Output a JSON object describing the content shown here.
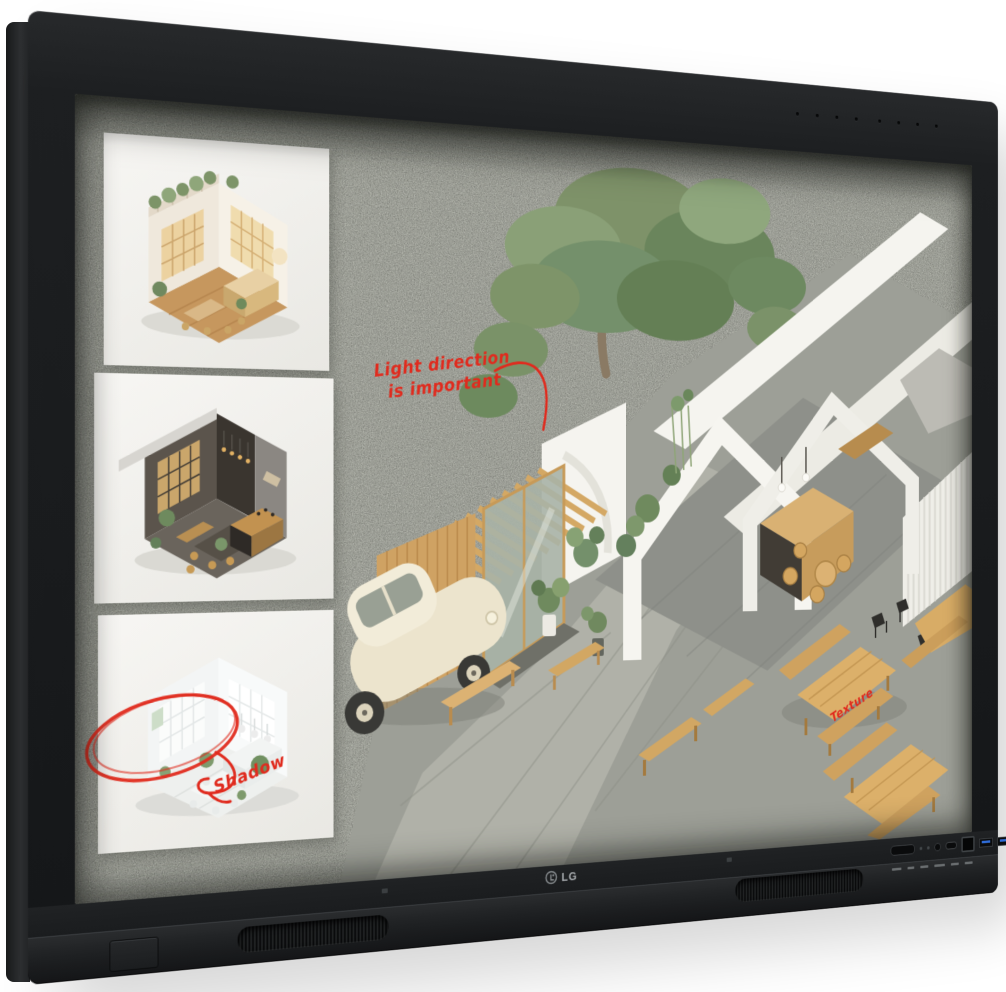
{
  "monitor": {
    "brand_logo": "LG",
    "bezel_color": "#1d1f21",
    "usb_accent_color": "#2f6cd8",
    "mic_hole_count": 8
  },
  "board": {
    "felt_color": "#b0b3a8",
    "ink_color": "#e02b1e",
    "annotations": {
      "light_direction_line1": "Light direction",
      "light_direction_line2": "is important",
      "shadow": "Shadow",
      "texture": "Texture"
    },
    "cafe_sign": "CAFE",
    "thumbnails": [
      {
        "icon": "warm-cafe-interior-render"
      },
      {
        "icon": "dark-lounge-interior-render"
      },
      {
        "icon": "white-room-interior-render"
      }
    ],
    "main_scene_icons": [
      "tree-icon",
      "cafe-building-icon",
      "vintage-car-icon",
      "picnic-tables-icon"
    ]
  }
}
